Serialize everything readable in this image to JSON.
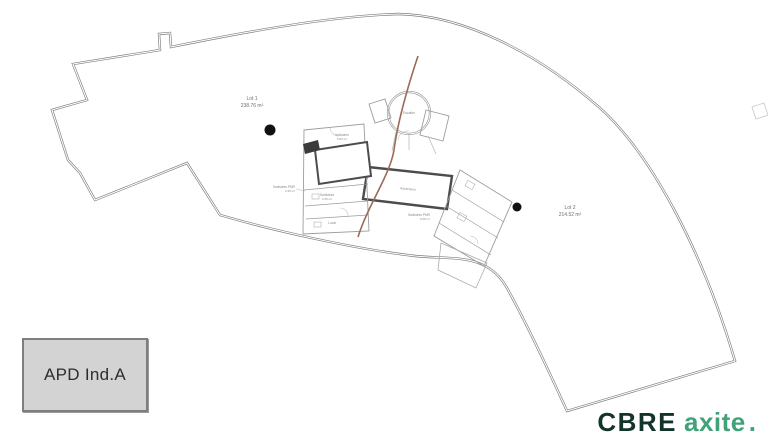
{
  "plan": {
    "lot1": {
      "name": "Lot 1",
      "area": "238.76 m²"
    },
    "lot2": {
      "name": "Lot 2",
      "area": "214.52 m²"
    },
    "rooms": {
      "sanitaires_pmr_left": {
        "name": "Sanitaires PMR",
        "area": "3.35 m²"
      },
      "sanitaires_pmr_right": {
        "name": "Sanitaires PMR",
        "area": "3.06 m²"
      },
      "vestiaires": {
        "name": "Vestiaires",
        "area": "5.80 m²"
      },
      "sanitaires": {
        "name": "Sanitaires",
        "area": "4.35 m²"
      },
      "local": {
        "name": "Local",
        "area": "2.90 m²"
      },
      "escalier": {
        "name": "Escalier"
      },
      "ascenseur": {
        "name": "Ascenseur"
      }
    }
  },
  "title_block": {
    "label": "APD Ind.A"
  },
  "logo": {
    "cbre": "CBRE",
    "axite": "axite",
    "dot": "."
  },
  "colors": {
    "wall_outline": "#7d7d7d",
    "interior_line": "#9c9c9c",
    "thick_wall": "#4c4c4c",
    "separation_line": "#9a6a5a",
    "marker_dot": "#111111",
    "logo_dark_green": "#12342a",
    "logo_green": "#41a278",
    "title_block_bg": "#d3d3d3"
  }
}
